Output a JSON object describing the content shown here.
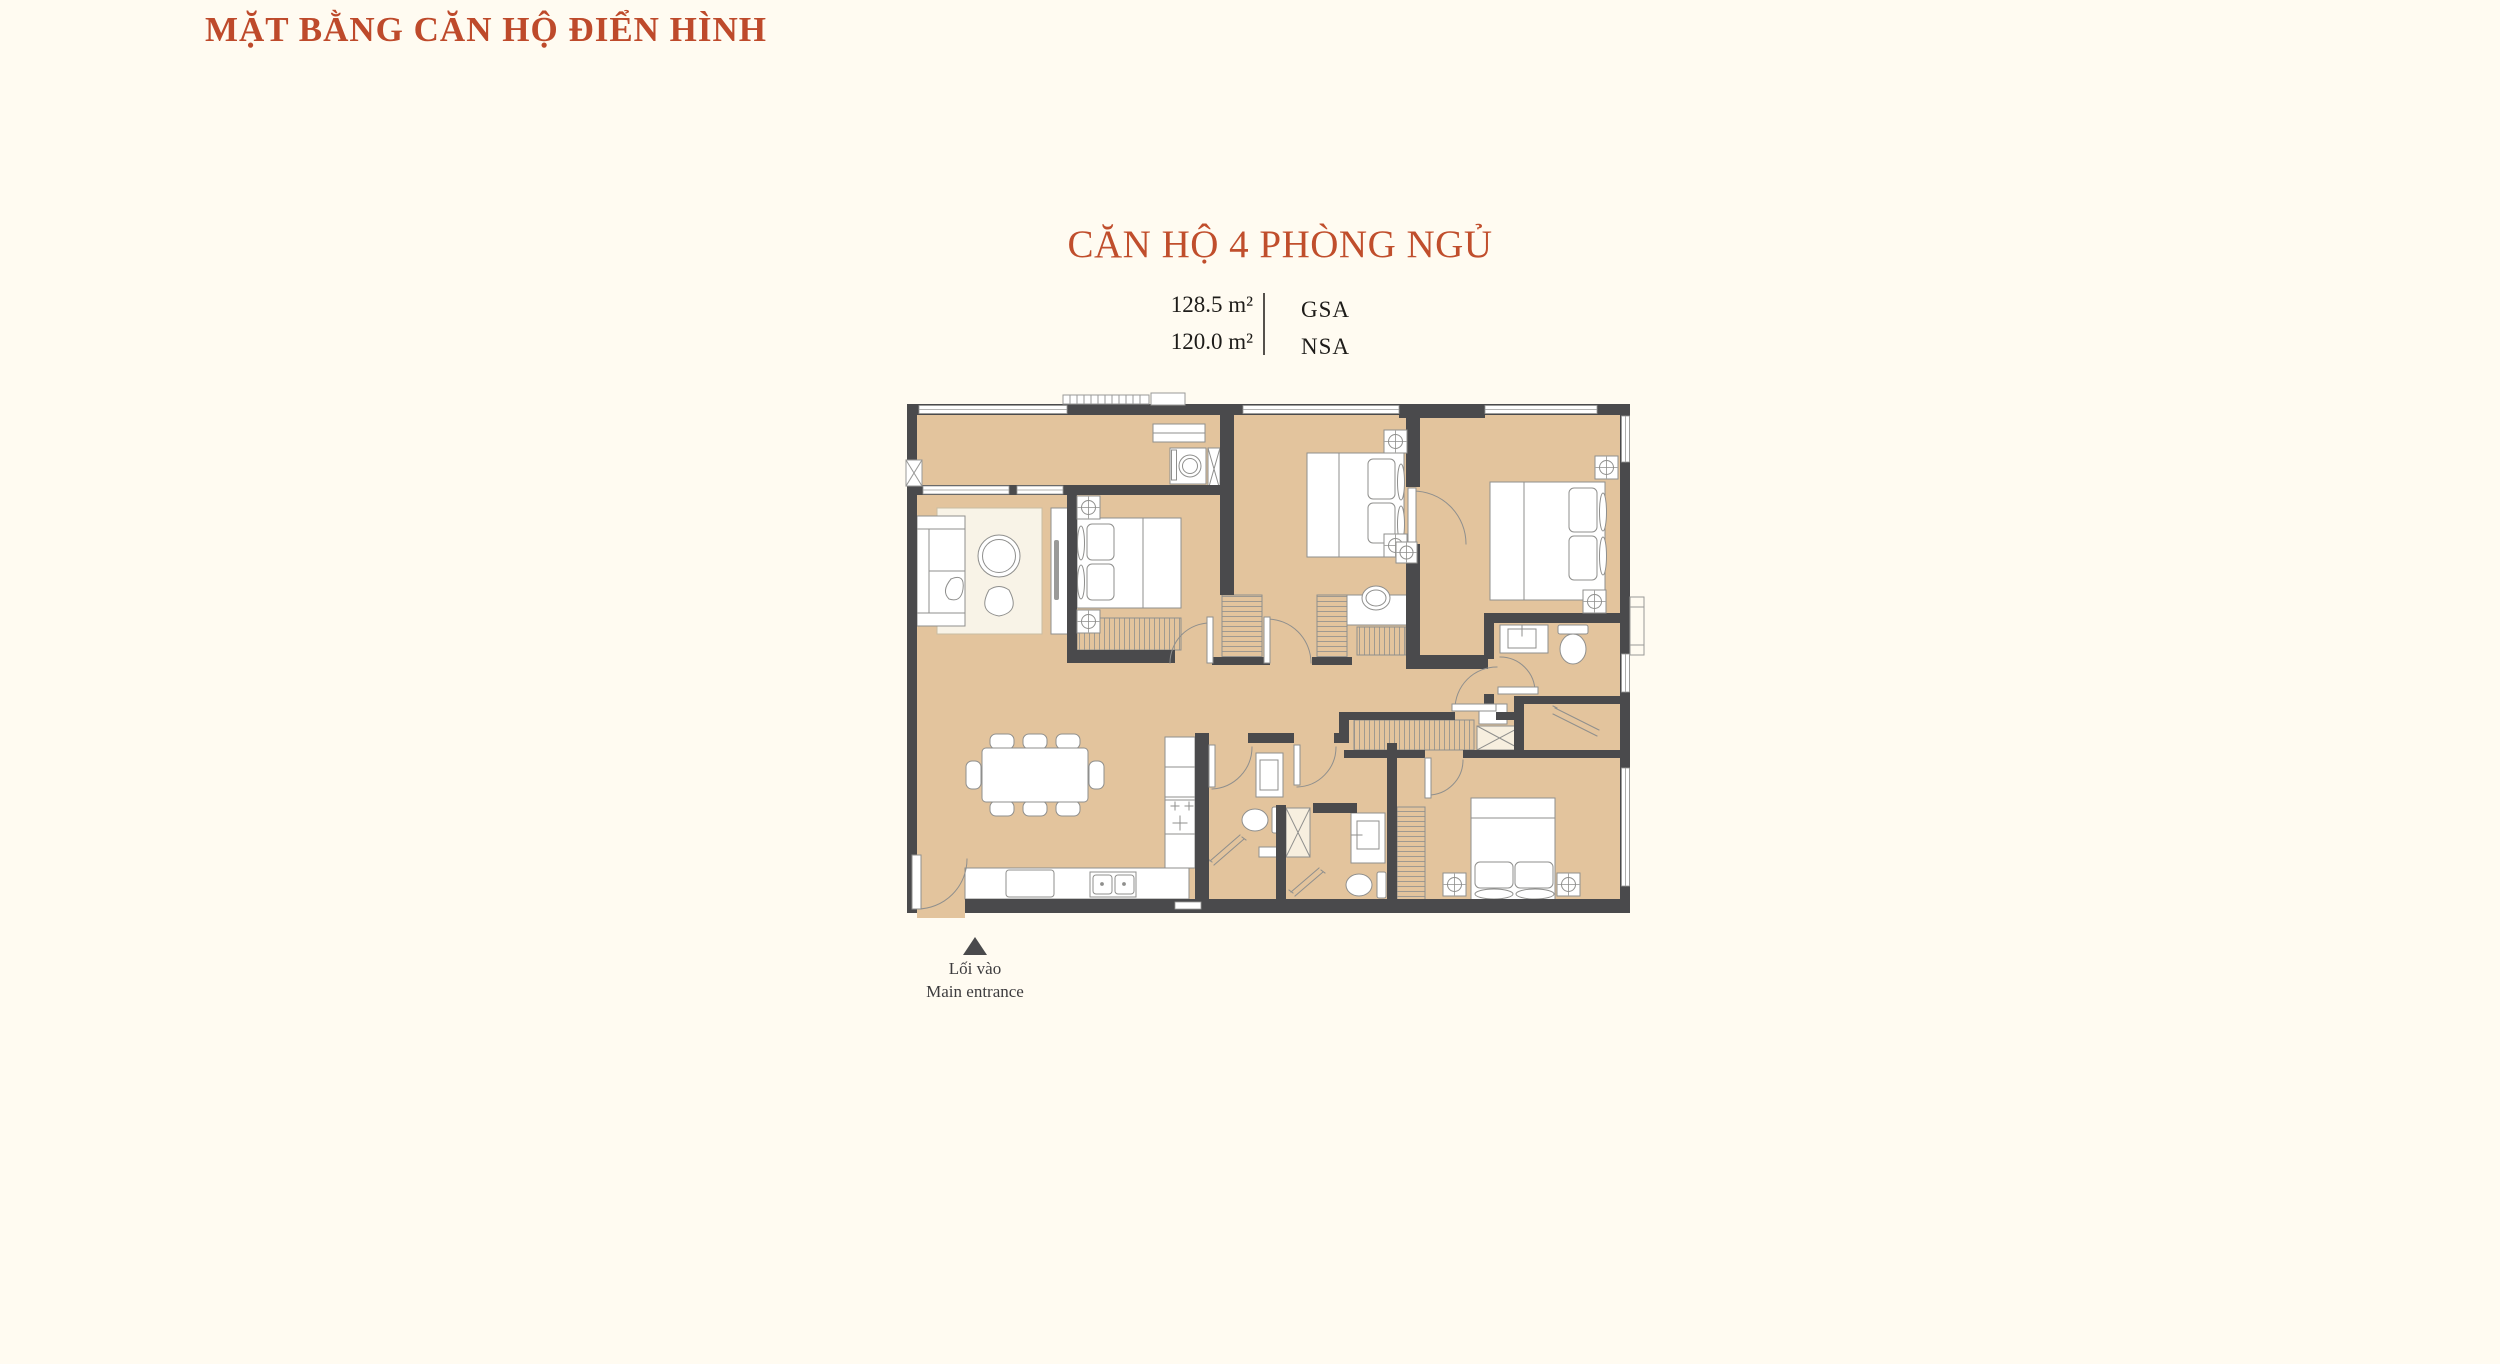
{
  "page": {
    "background": "#FFFBF1",
    "kind": "apartment-floor-plan-sheet"
  },
  "header": {
    "title": "MẶT BẰNG CĂN HỘ ĐIỂN HÌNH",
    "title_color": "#BE4A2B"
  },
  "unit": {
    "heading": "CĂN HỘ 4 PHÒNG NGỦ",
    "heading_color": "#C04E2C",
    "areas": [
      {
        "value": "128.5 m²",
        "label": "GSA"
      },
      {
        "value": "120.0 m²",
        "label": "NSA"
      }
    ]
  },
  "entrance": {
    "line1": "Lối vào",
    "line2": "Main entrance",
    "marker_icon": "up-triangle-icon"
  },
  "floorplan": {
    "colors": {
      "floor": "#E3C49D",
      "wall": "#4A4A4C",
      "furniture_line": "#8F8F8D",
      "furniture_fill": "#FFFFFF",
      "shaft_fill": "#F7EFDF",
      "rug_fill": "#F8F3E7"
    },
    "features": [
      "living-dining-room",
      "kitchen",
      "bedroom-1",
      "bedroom-2",
      "bedroom-3",
      "bedroom-4",
      "bathroom-master",
      "bathroom-common",
      "bathroom-ensuite",
      "loggia-laundry",
      "wardrobes",
      "entry-door",
      "balcony-ledge"
    ]
  }
}
